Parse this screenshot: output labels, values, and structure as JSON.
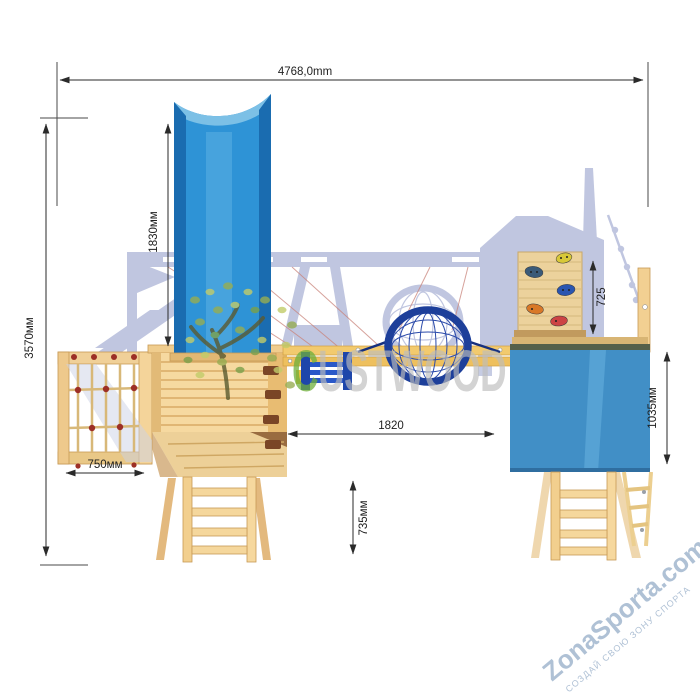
{
  "drawing": {
    "kind": "playground-technical-drawing",
    "dimensions": {
      "overall_width": "4768,0mm",
      "overall_height": "3570мм",
      "slide_height": "1830мм",
      "climb_net_width": "750мм",
      "left_ladder_height": "735мм",
      "tower_span": "1820",
      "climb_wall_height": "725",
      "right_tower_height": "1035мм"
    },
    "watermarks": {
      "brand_initial": "C",
      "brand_rest": "USTWOOD",
      "site": "ZonaSporta.com",
      "tagline": "СОЗДАЙ СВОЮ ЗОНУ СПОРТА"
    },
    "colors": {
      "wood_light": "#f6dca4",
      "wood_mid": "#eccb86",
      "wood_dark": "#c79a55",
      "slide_blue": "#2e93d6",
      "slide_blue_dark": "#1a6cb0",
      "tarp_blue": "#418fc6",
      "swing_navy": "#1d3f9a",
      "silhouette": "#c0c6e0",
      "dimension_ink": "#2a2a2a",
      "brand_green": "#6faf3c",
      "watermark_gray": "#bdbdbd",
      "site_blue": "#a9bcd2"
    }
  }
}
